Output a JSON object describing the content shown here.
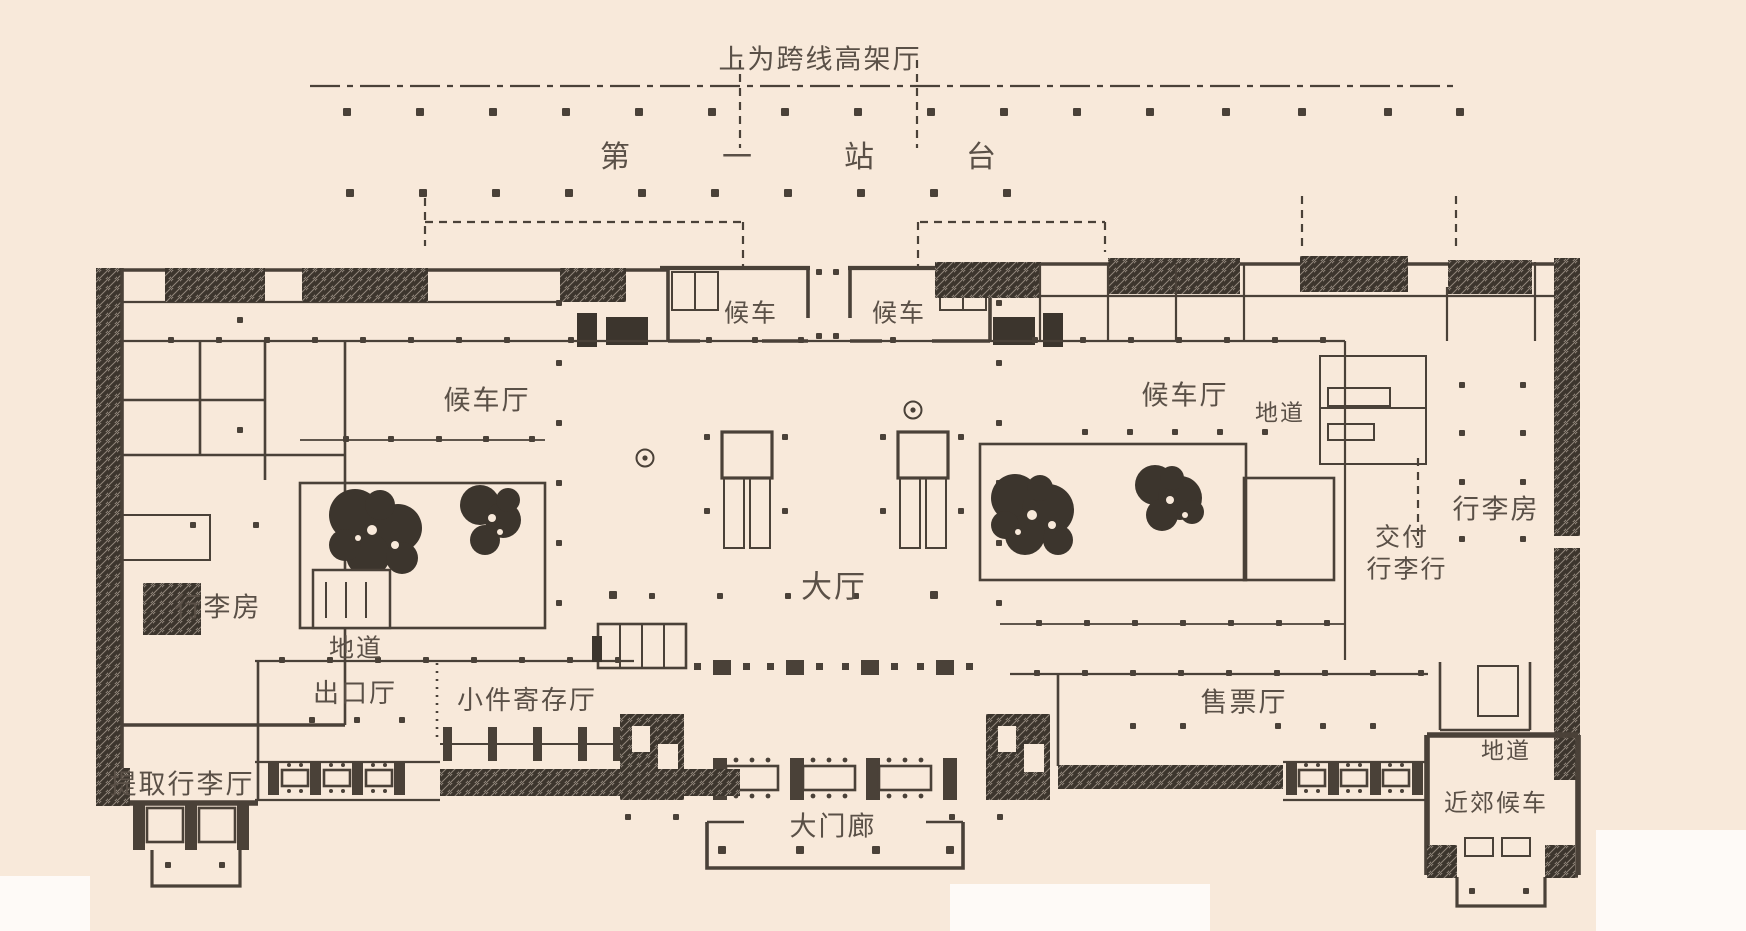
{
  "plan": {
    "kind": "architectural-floor-plan",
    "labels": {
      "elevated_hall_above": "上为跨线高架厅",
      "platform_1": "第一站台",
      "waiting_left": "候车",
      "waiting_right": "候车",
      "waiting_hall_left": "候车厅",
      "waiting_hall_right": "候车厅",
      "underpass_upper_right": "地道",
      "luggage_room_right": "行李房",
      "luggage_room_left": "行李房",
      "underpass_left": "地道",
      "main_hall": "大厅",
      "luggage_delivery_line1": "交付",
      "luggage_delivery_line2": "行李行",
      "exit_hall": "出口厅",
      "parcel_check_hall": "小件寄存厅",
      "ticket_hall": "售票厅",
      "luggage_claim_hall": "提取行李厅",
      "underpass_lower_right": "地道",
      "suburban_waiting": "近郊候车",
      "main_portico": "大门廊"
    },
    "colors": {
      "paper": "#f8e9da",
      "ink": "#4a4138",
      "dark": "#3c352d",
      "text": "#5a5047"
    }
  }
}
